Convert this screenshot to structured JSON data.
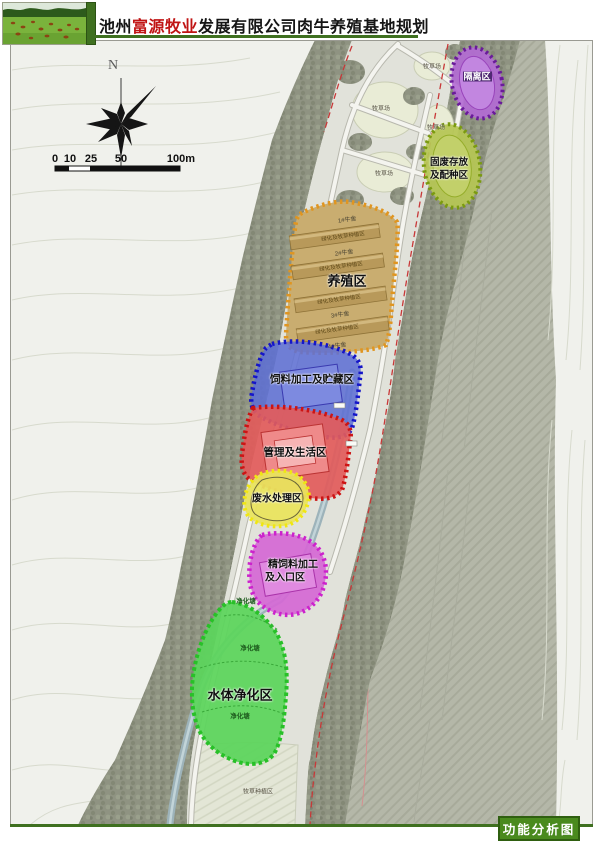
{
  "header": {
    "title_prefix": "池州",
    "title_highlight": "富源牧业",
    "title_suffix": "发展有限公司肉牛养殖基地规划",
    "highlight_color": "#c01414",
    "accent_green": "#3f7020"
  },
  "compass": {
    "north": "N"
  },
  "scale_bar": {
    "tick_0": "0",
    "tick_10": "10",
    "tick_25": "25",
    "tick_50": "50",
    "tick_100": "100m"
  },
  "zones": {
    "isolation": {
      "label": "隔离区",
      "fill": "#b36bd4",
      "border": "#6a1b9a"
    },
    "solid_waste": {
      "line1": "固废存放",
      "line2": "及配种区",
      "fill": "#b6c655",
      "border": "#7a9a10"
    },
    "breeding": {
      "label": "养殖区",
      "greening_label": "绿化及牧草种植区",
      "barn_labels": [
        "1#牛舍",
        "2#牛舍",
        "3#牛舍",
        "4#牛舍"
      ],
      "fill": "#c9ad70",
      "border": "#e09520"
    },
    "feed": {
      "label": "饲料加工及贮藏区",
      "fill": "#5f6fd4",
      "border": "#1515c8"
    },
    "management": {
      "label": "管理及生活区",
      "fill": "#e25b5b",
      "border": "#cc1414"
    },
    "wastewater": {
      "label": "废水处理区",
      "fill": "#e9e35e",
      "border": "#f0e612"
    },
    "concentrate": {
      "line1": "精饲料加工",
      "line2": "及入口区",
      "fill": "#d568d5",
      "border": "#cc22cc"
    },
    "water_purification": {
      "label": "水体净化区",
      "pond_label": "净化塘",
      "fill": "#5cd45c",
      "border": "#28c028"
    }
  },
  "land_labels": {
    "pasture": "牧草场",
    "planting": "牧草种植区"
  },
  "footer": {
    "caption": "功能分析图"
  }
}
